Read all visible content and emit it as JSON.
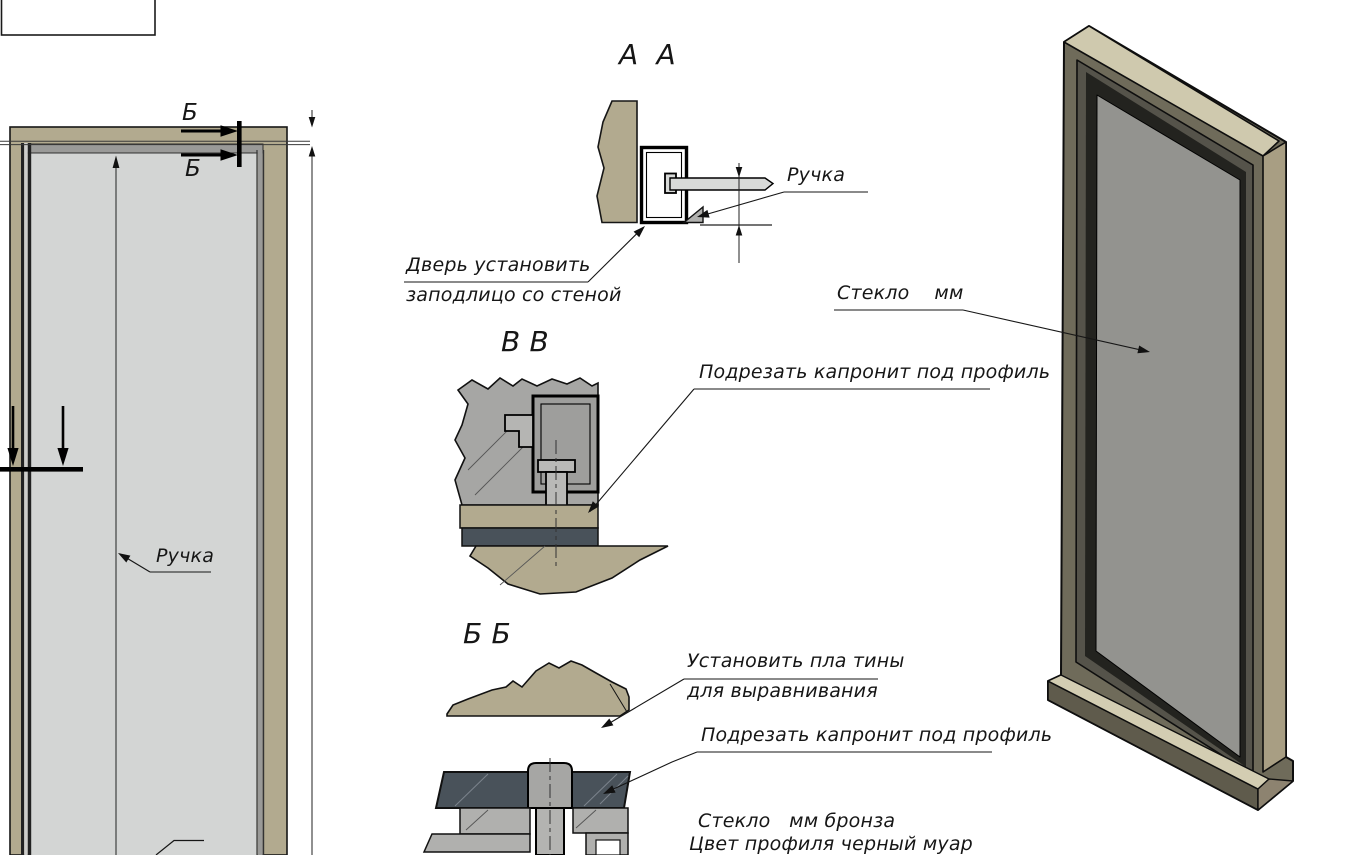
{
  "page": {
    "width": 1351,
    "height": 855,
    "background": "#ffffff"
  },
  "colors": {
    "frame_tan": "#b2aa8f",
    "frame_top_khaki": "#cfc9ae",
    "frame_side_tan": "#a89e83",
    "frame_front_olive": "#6f6b5a",
    "sill_olive": "#5f5b4c",
    "glass_elevation": "#d3d5d4",
    "glass_iso": "#93938f",
    "profile_gray": "#a6a6a4",
    "gasket_slate": "#49525a",
    "line": "#161616"
  },
  "views": {
    "door_elevation": {
      "section_mark_top": "Б",
      "section_mark_bottom": "Б",
      "handle_label": "Ручка"
    },
    "section_aa": {
      "title": "А  А",
      "handle_label": "Ручка",
      "note_line1": "Дверь установить",
      "note_line2": "заподлицо со стеной"
    },
    "section_vv": {
      "title": "В В",
      "note_trim": "Подрезать капронит под профиль"
    },
    "section_bb": {
      "title": "Б Б",
      "note_plates_line1": "Установить пла тины",
      "note_plates_line2": "для выравнивания",
      "note_trim": "Подрезать капронит под профиль",
      "note_glass_line1": "Стекло   мм бронза",
      "note_glass_line2": "Цвет профиля черный муар"
    },
    "iso_view": {
      "glass_label": "Стекло    мм"
    }
  }
}
